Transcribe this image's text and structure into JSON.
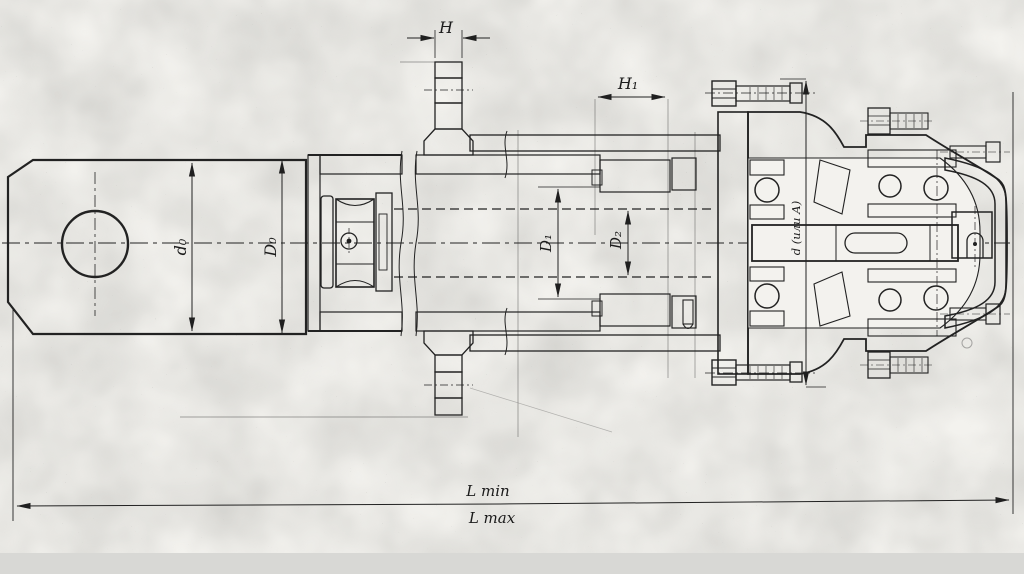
{
  "drawing": {
    "dimension_labels": {
      "h": "H",
      "h1": "H₁",
      "d0": "d₀",
      "D0": "D₀",
      "D1": "D₁",
      "D2": "D₂",
      "d_or_A": "d (или А)",
      "l_min": "L min",
      "l_max": "L max"
    },
    "colors": {
      "paper": "#f3f2ee",
      "ink": "#1f1f1f",
      "scan_band": "#d8d8d5"
    }
  }
}
